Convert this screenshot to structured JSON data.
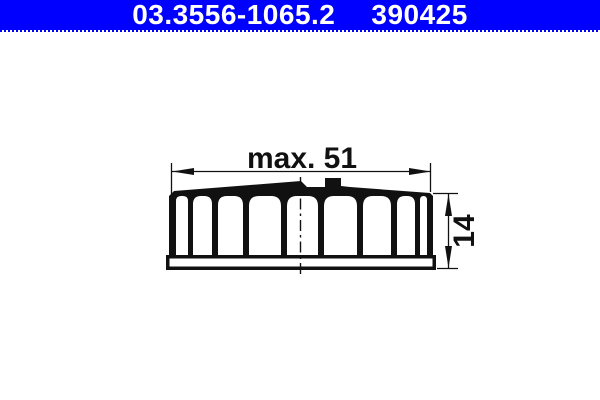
{
  "header": {
    "part_number": "03.3556-1065.2",
    "reference_number": "390425",
    "background_color": "#0000ff",
    "text_color": "#ffffff"
  },
  "drawing": {
    "line_color": "#111111",
    "background_color": "#ffffff",
    "dimensions": [
      {
        "label": "max. 51",
        "orientation": "horizontal"
      },
      {
        "label": "14",
        "orientation": "vertical"
      }
    ]
  }
}
